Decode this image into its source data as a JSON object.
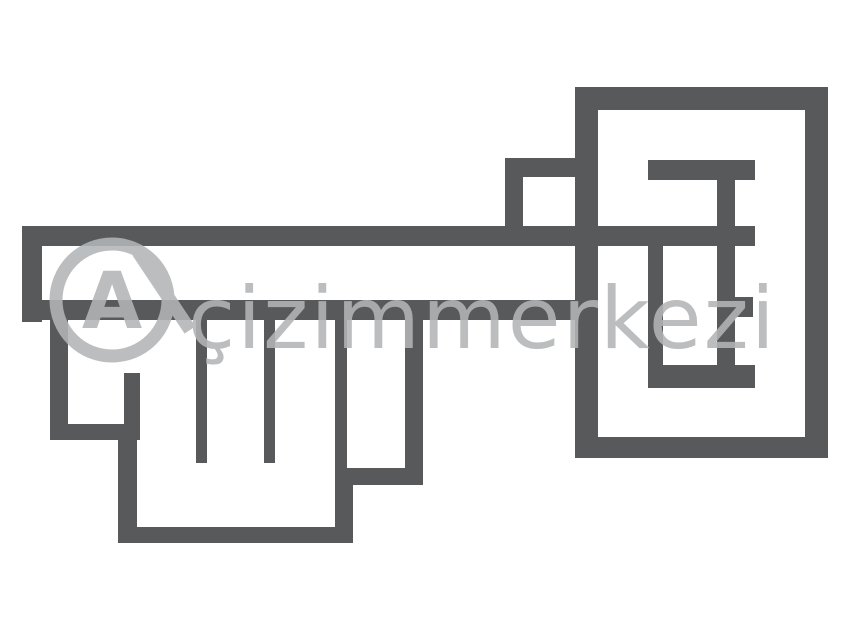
{
  "canvas": {
    "width": 850,
    "height": 630,
    "background_color": "#ffffff"
  },
  "drawing": {
    "description": "key-shaped floor plan outline drawing",
    "wall_color": "#58595b",
    "walls": [
      {
        "name": "bow-top-wall",
        "x": 575,
        "y": 87,
        "w": 253,
        "h": 23
      },
      {
        "name": "bow-left-wall",
        "x": 575,
        "y": 87,
        "w": 23,
        "h": 371
      },
      {
        "name": "bow-right-wall",
        "x": 805,
        "y": 87,
        "w": 23,
        "h": 371
      },
      {
        "name": "bow-bottom-wall",
        "x": 575,
        "y": 437,
        "w": 253,
        "h": 21
      },
      {
        "name": "comb-top-bar",
        "x": 648,
        "y": 160,
        "w": 107,
        "h": 20
      },
      {
        "name": "comb-right-post",
        "x": 717,
        "y": 178,
        "w": 18,
        "h": 210
      },
      {
        "name": "comb-left-post",
        "x": 648,
        "y": 244,
        "w": 15,
        "h": 144
      },
      {
        "name": "comb-mid-stub",
        "x": 735,
        "y": 297,
        "w": 18,
        "h": 20
      },
      {
        "name": "comb-bottom-bar",
        "x": 648,
        "y": 365,
        "w": 107,
        "h": 23
      },
      {
        "name": "shaft-top-wall",
        "x": 22,
        "y": 226,
        "w": 733,
        "h": 20
      },
      {
        "name": "shaft-bottom-wall",
        "x": 22,
        "y": 300,
        "w": 558,
        "h": 20
      },
      {
        "name": "shaft-left-cap",
        "x": 22,
        "y": 226,
        "w": 20,
        "h": 96
      },
      {
        "name": "ward-top-wall",
        "x": 505,
        "y": 158,
        "w": 92,
        "h": 19
      },
      {
        "name": "ward-left-wall",
        "x": 505,
        "y": 158,
        "w": 18,
        "h": 88
      },
      {
        "name": "bit-left-wall",
        "x": 50,
        "y": 315,
        "w": 18,
        "h": 123
      },
      {
        "name": "bit-step1-floor",
        "x": 50,
        "y": 424,
        "w": 90,
        "h": 16
      },
      {
        "name": "bit-door-post",
        "x": 124,
        "y": 373,
        "w": 16,
        "h": 62
      },
      {
        "name": "bit-step1-drop",
        "x": 118,
        "y": 424,
        "w": 19,
        "h": 119
      },
      {
        "name": "bit-bottom-floor",
        "x": 118,
        "y": 527,
        "w": 235,
        "h": 16
      },
      {
        "name": "bit-step2-drop",
        "x": 335,
        "y": 468,
        "w": 18,
        "h": 75
      },
      {
        "name": "bit-step2-floor",
        "x": 335,
        "y": 468,
        "w": 88,
        "h": 17
      },
      {
        "name": "bit-right-wall",
        "x": 405,
        "y": 315,
        "w": 18,
        "h": 170
      },
      {
        "name": "tooth-1",
        "x": 196,
        "y": 312,
        "w": 11,
        "h": 151
      },
      {
        "name": "tooth-2",
        "x": 264,
        "y": 312,
        "w": 11,
        "h": 151
      },
      {
        "name": "tooth-3",
        "x": 335,
        "y": 312,
        "w": 12,
        "h": 160
      }
    ]
  },
  "watermark": {
    "text": "çizimmerkezi",
    "logo_letter": "A",
    "color": "#b2b5b7"
  }
}
